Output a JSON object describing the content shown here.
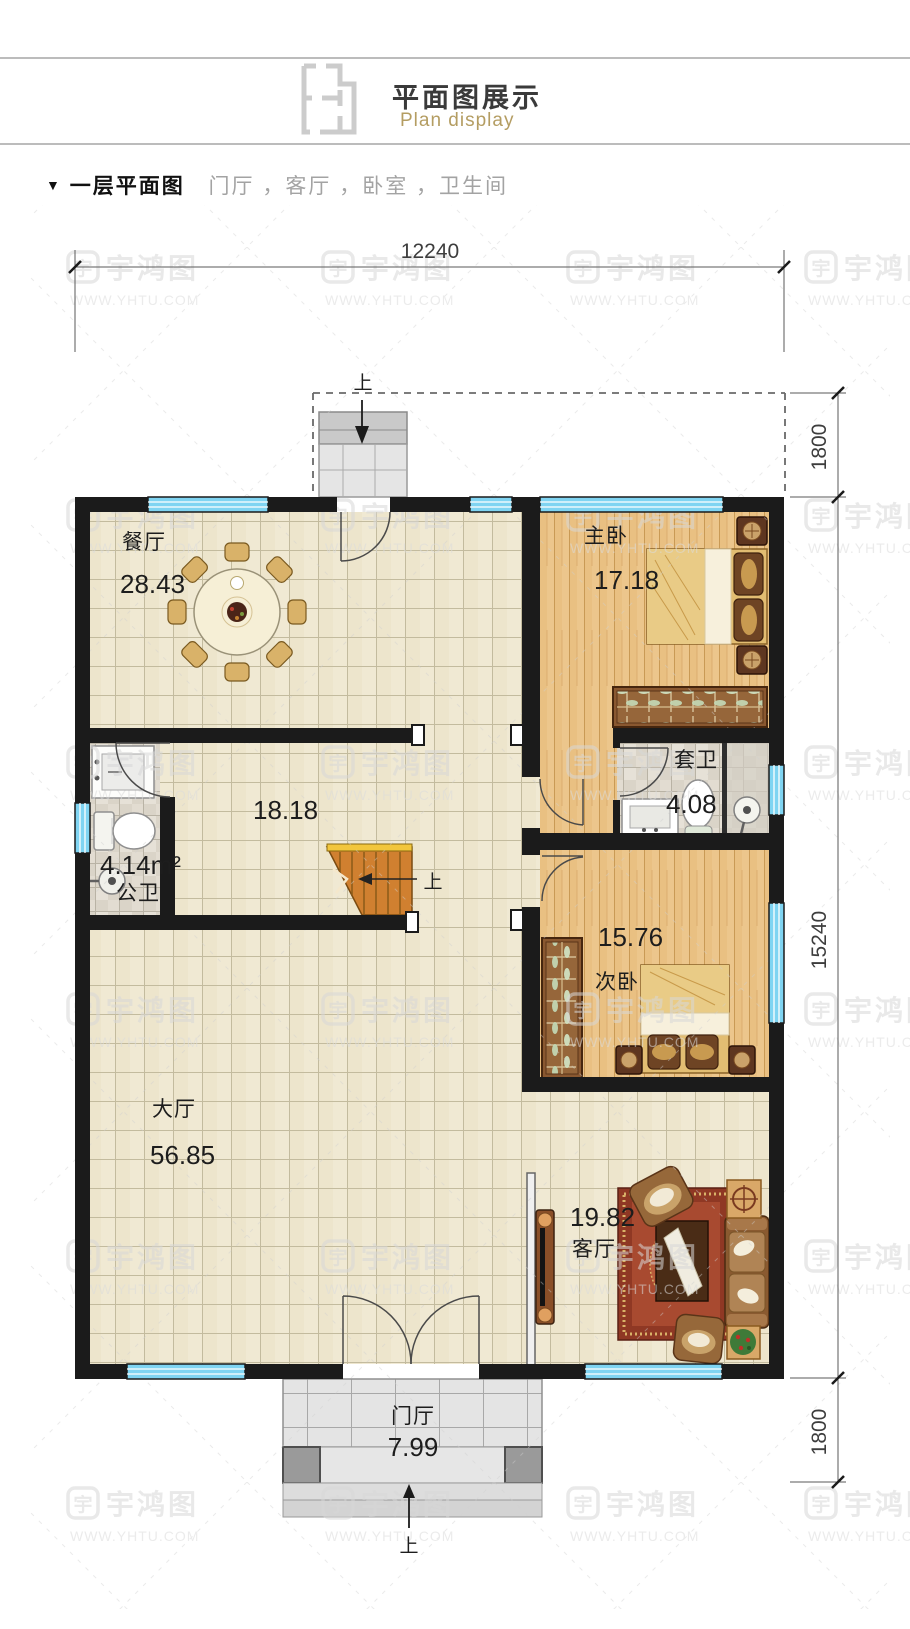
{
  "header": {
    "title_zh": "平面图展示",
    "title_en": "Plan display"
  },
  "section": {
    "marker": "▼",
    "title": "一层平面图",
    "subtitle": "门厅 ，客厅 ，卧室 ，卫生间"
  },
  "dims": {
    "top": "12240",
    "right_top": "1800",
    "right_main": "15240",
    "right_bottom": "1800"
  },
  "rooms": {
    "dining": {
      "name": "餐厅",
      "area": "28.43"
    },
    "master": {
      "name": "主卧",
      "area": "17.18"
    },
    "ensuite": {
      "name": "套卫",
      "area": "4.08"
    },
    "public_bath": {
      "name": "公卫",
      "area": "4.14m²"
    },
    "mid_hall": {
      "area": "18.18"
    },
    "second_bed": {
      "name": "次卧",
      "area": "15.76"
    },
    "great_hall": {
      "name": "大厅",
      "area": "56.85"
    },
    "living": {
      "name": "客厅",
      "area": "19.82"
    },
    "foyer": {
      "name": "门厅",
      "area": "7.99"
    }
  },
  "stairs": {
    "up": "上"
  },
  "watermark": {
    "logo_char": "宇",
    "brand": "宇鸿图",
    "url": "WWW.YHTU.COM"
  },
  "colors": {
    "wall": "#1b1b1b",
    "window_blue": "#7fd4f2",
    "tile_floor": "#f0e9d3",
    "wood_floor": "#ecc68c",
    "stair_orange": "#d08030",
    "rug_red": "#a8422c",
    "accent_gold": "#b49d62",
    "watermark_gray": "#d8d8d8"
  }
}
